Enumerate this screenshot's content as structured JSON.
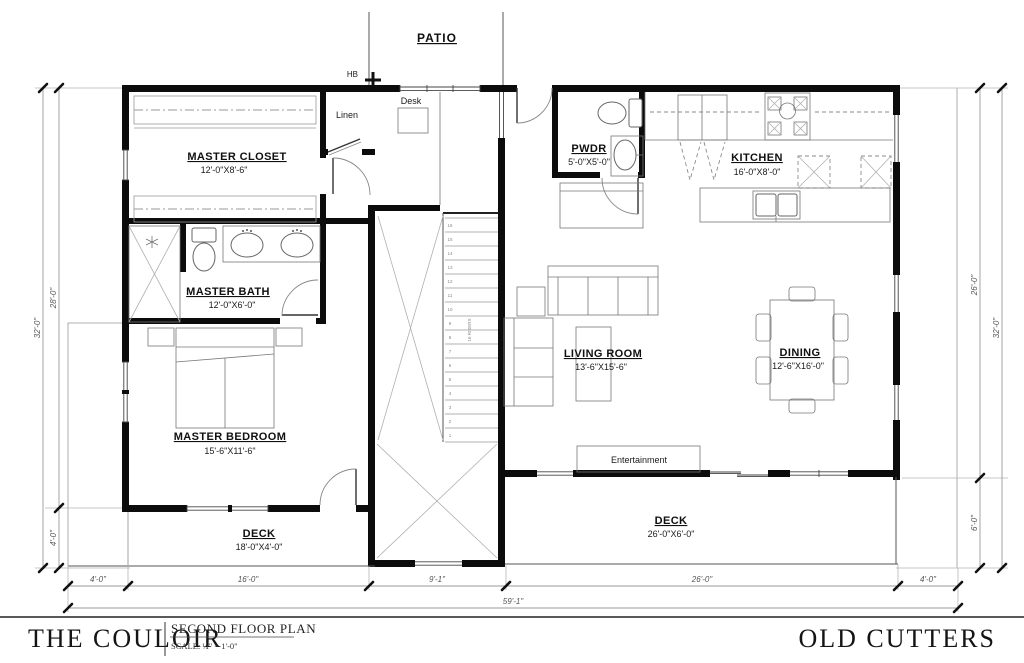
{
  "plan": {
    "annotations": {
      "patio": "PATIO",
      "hb": "HB",
      "linen": "Linen",
      "desk": "Desk",
      "entertainment": "Entertainment"
    },
    "rooms": {
      "master_closet": {
        "name": "MASTER CLOSET",
        "dims": "12'-0\"X8'-6\""
      },
      "master_bath": {
        "name": "MASTER BATH",
        "dims": "12'-0\"X6'-0\""
      },
      "master_bedroom": {
        "name": "MASTER BEDROOM",
        "dims": "15'-6\"X11'-6\""
      },
      "pwdr": {
        "name": "PWDR",
        "dims": "5'-0\"X5'-0\""
      },
      "kitchen": {
        "name": "KITCHEN",
        "dims": "16'-0\"X8'-0\""
      },
      "living_room": {
        "name": "LIVING ROOM",
        "dims": "13'-6\"X15'-6\""
      },
      "dining": {
        "name": "DINING",
        "dims": "12'-6\"X16'-0\""
      },
      "deck_left": {
        "name": "DECK",
        "dims": "18'-0\"X4'-0\""
      },
      "deck_right": {
        "name": "DECK",
        "dims": "26'-0\"X6'-0\""
      }
    },
    "stairs": {
      "note": "16 RISERS",
      "treads": [
        "16",
        "15",
        "14",
        "13",
        "12",
        "11",
        "10",
        "9",
        "8",
        "7",
        "6",
        "5",
        "4",
        "3",
        "2",
        "1"
      ]
    },
    "dimensions": {
      "bottom": [
        "4'-0\"",
        "16'-0\"",
        "9'-1\"",
        "26'-0\"",
        "4'-0\""
      ],
      "bottom_total": "59'-1\"",
      "left": {
        "inner_upper": "28'-0\"",
        "inner_lower": "4'-0\"",
        "outer": "32'-0\""
      },
      "right": {
        "inner_upper": "26'-0\"",
        "inner_lower": "6'-0\"",
        "outer": "32'-0\""
      }
    }
  },
  "title_block": {
    "project": "THE COULOIR",
    "sheet_title": "SECOND FLOOR PLAN",
    "scale": "SCALE: ¼\" = 1'-0\"",
    "development": "OLD CUTTERS"
  }
}
